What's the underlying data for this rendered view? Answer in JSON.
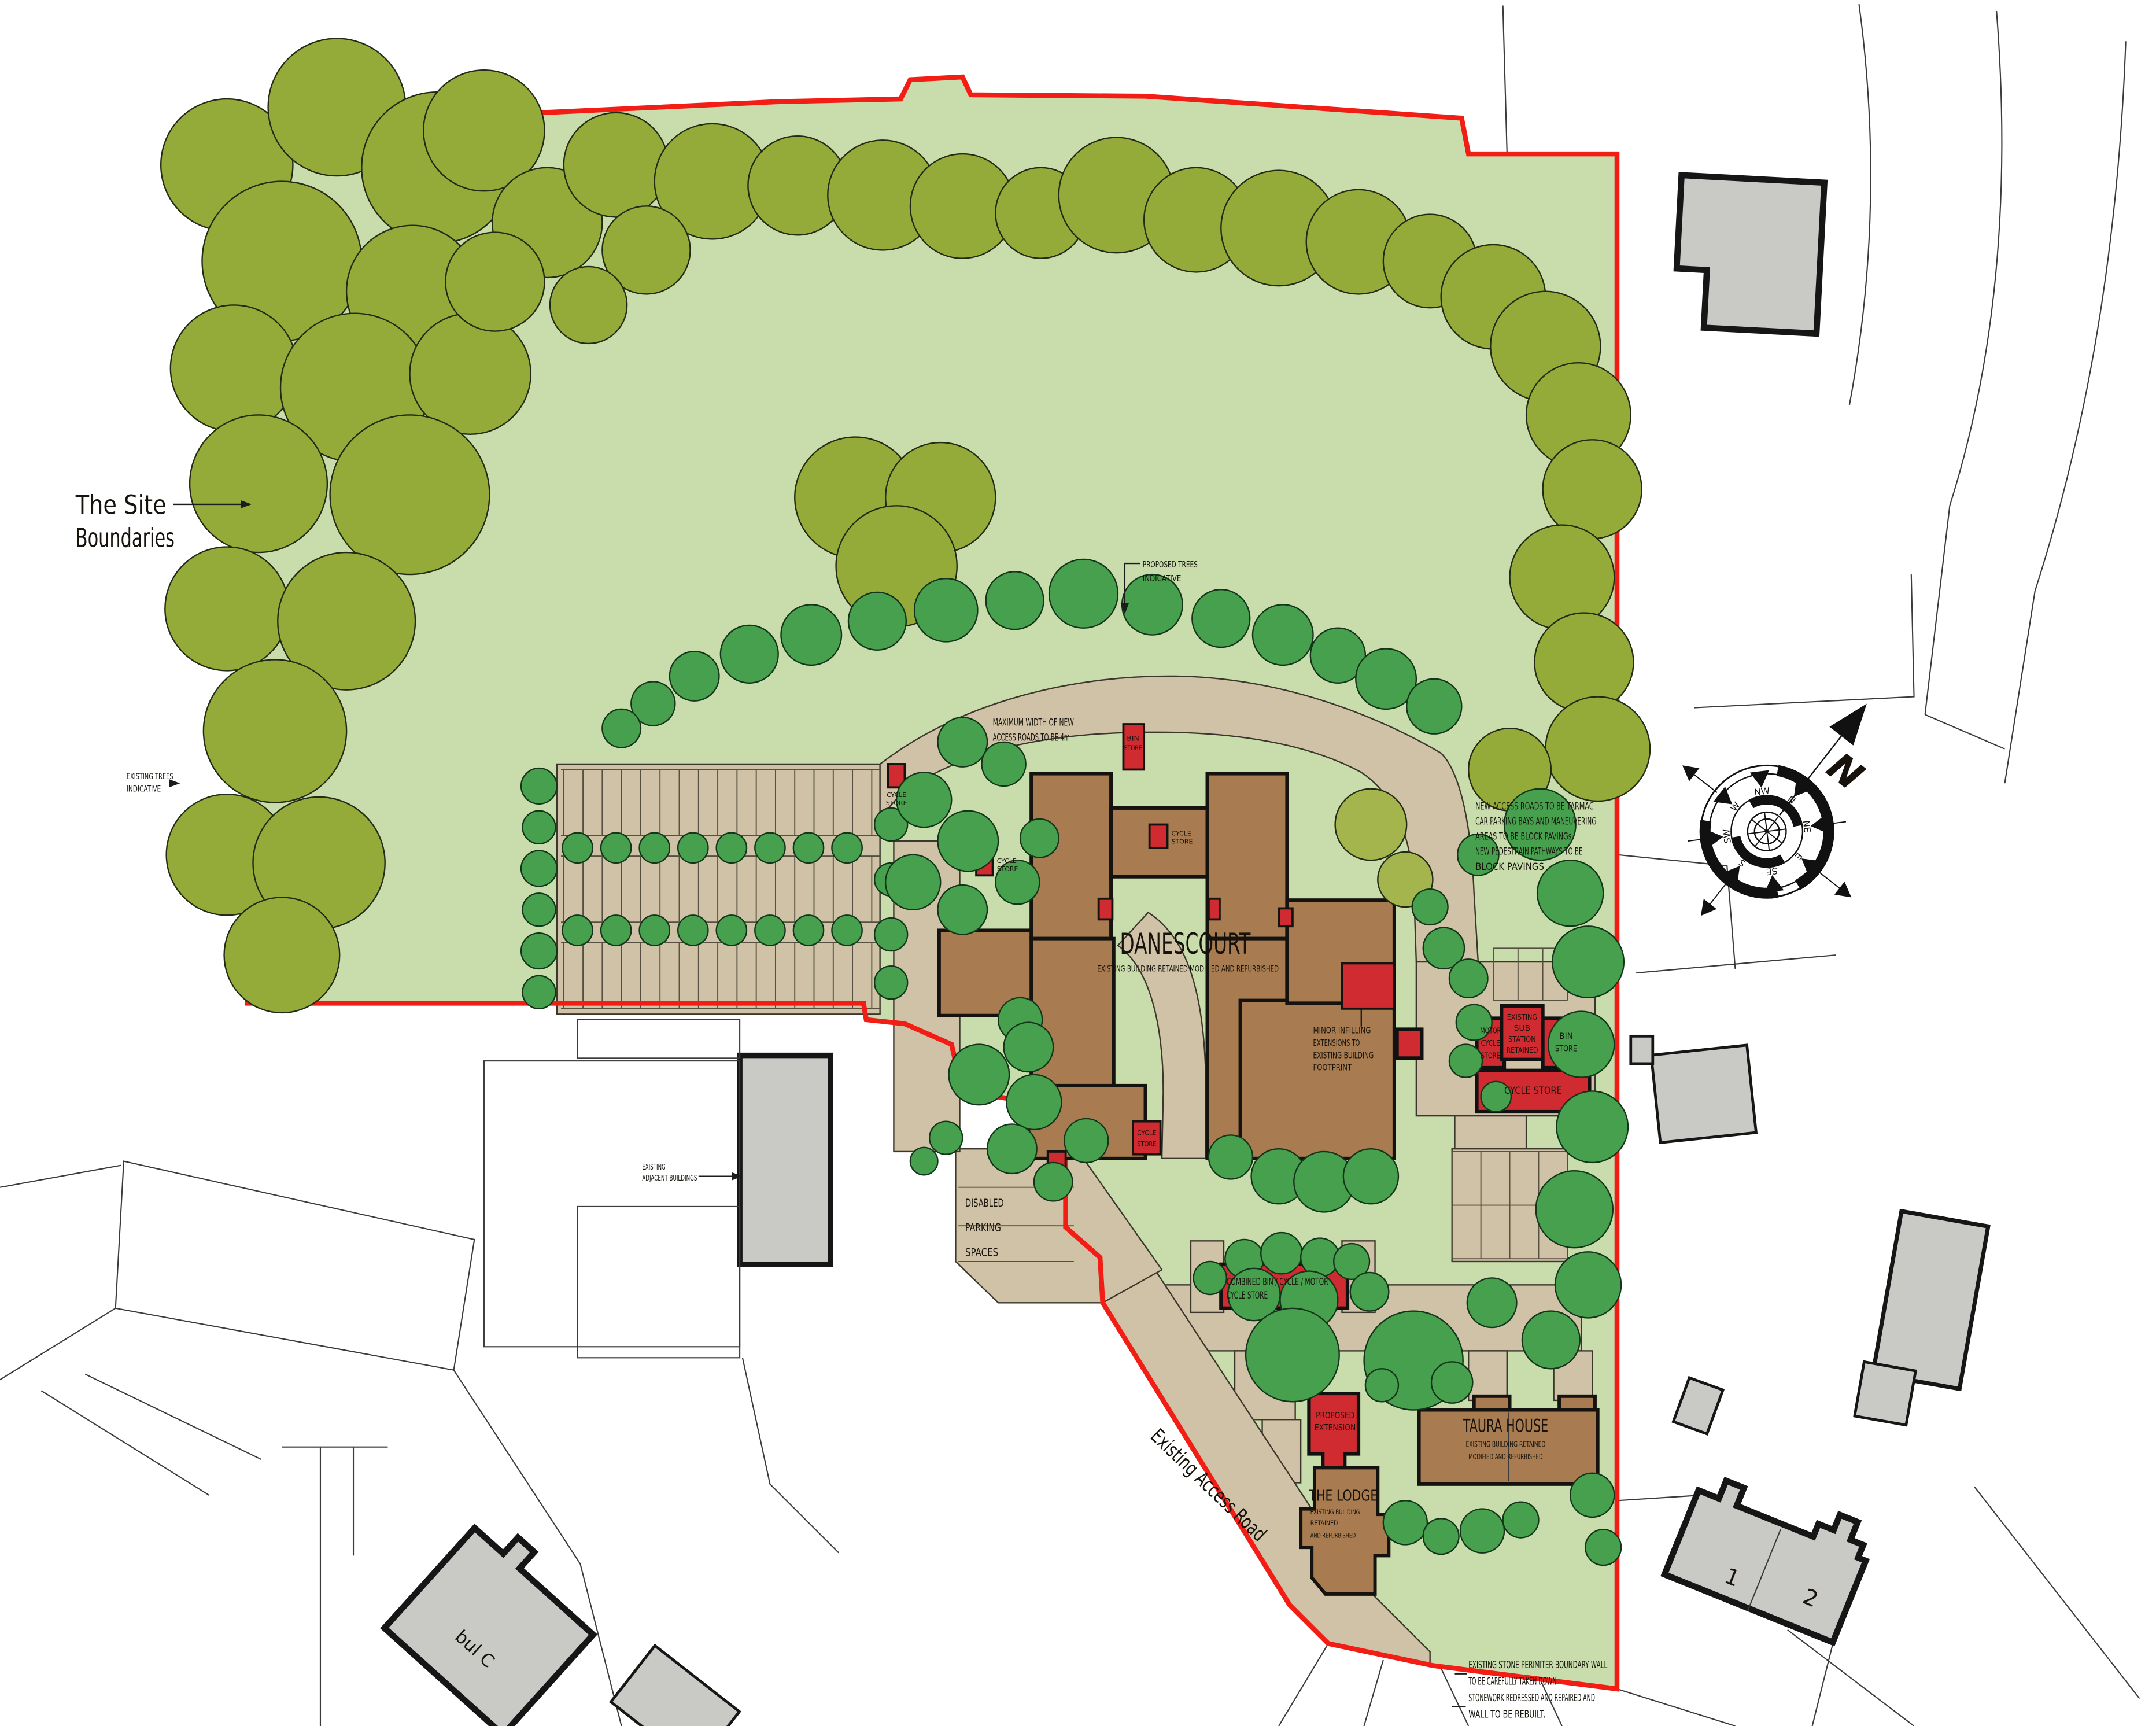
{
  "title": "Danescourt landscape site plan",
  "labels": {
    "site1": "The Site",
    "site2": "Boundaries",
    "ext1": "EXISTING TREES",
    "ext2": "INDICATIVE",
    "pt1": "PROPOSED TREES",
    "pt2": "INDICATIVE",
    "mw1": "MAXIMUM WIDTH OF NEW",
    "mw2": "ACCESS ROADS TO BE 4m",
    "an1": "NEW ACCESS ROADS TO BE TARMAC",
    "an2": "CAR PARKING BAYS AND MANEUVERING",
    "an3": "AREAS TO BE BLOCK PAVINGs",
    "an4": "NEW PEDESTRAIN PATHWAYS TO BE",
    "an5": "BLOCK PAVINGS",
    "mi1": "MINOR INFILLING",
    "mi2": "EXTENSIONS TO",
    "mi3": "EXISTING BUILDING",
    "mi4": "FOOTPRINT",
    "danescourt": "DANESCOURT",
    "danescourt_sub": "EXISTING BUILDING RETAINED MODIFIED AND REFURBISHED",
    "taura": "TAURA HOUSE",
    "taura_sub1": "EXISTING BUILDING RETAINED",
    "taura_sub2": "MODIFIED AND REFURBISHED",
    "lodge": "THE LODGE",
    "lodge_sub1": "EXISTING BUILDING",
    "lodge_sub2": "RETAINED",
    "lodge_sub3": "AND REFURBISHED",
    "pe1": "PROPOSED",
    "pe2": "EXTENSION",
    "mc1": "MOTOR",
    "mc2": "CYCLE",
    "mc3": "STORE",
    "ss1": "EXISTING",
    "ss2": "SUB",
    "ss3": "STATION",
    "ss4": "RETAINED",
    "bin1": "BIN",
    "bin2": "STORE",
    "cycle_store": "CYCLE STORE",
    "cb1": "COMBINED BIN / CYCLE / MOTOR",
    "cb2": "CYCLE STORE",
    "dp1": "DISABLED",
    "dp2": "PARKING",
    "dp3": "SPACES",
    "road": "Existing Access Road",
    "adj1": "EXISTING",
    "adj2": "ADJACENT BUILDINGS",
    "wall1": "EXISTING STONE PERIMITER BOUNDARY WALL",
    "wall2": "TO BE CAREFULLY TAKEN DOWN",
    "wall3": "STONEWORK REDRESSED AND REPAIRED AND",
    "wall4": "WALL TO BE REBUILT.",
    "tiny1": "CYCLE",
    "tiny2": "STORE",
    "unit1": "1",
    "unit2": "2",
    "frag": "bul C"
  },
  "compass": {
    "north": "N",
    "points": [
      "N",
      "NE",
      "E",
      "SE",
      "S",
      "SW",
      "W",
      "NW"
    ]
  },
  "colors": {
    "site_green": "#c9dcab",
    "tree_existing": "#94aa39",
    "tree_proposed": "#47a04d",
    "road_tan": "#d0c2a6",
    "building_brown": "#a87c50",
    "accent_red": "#cf2b31",
    "boundary_red": "#f21d15",
    "building_grey": "#c9c9c6"
  }
}
